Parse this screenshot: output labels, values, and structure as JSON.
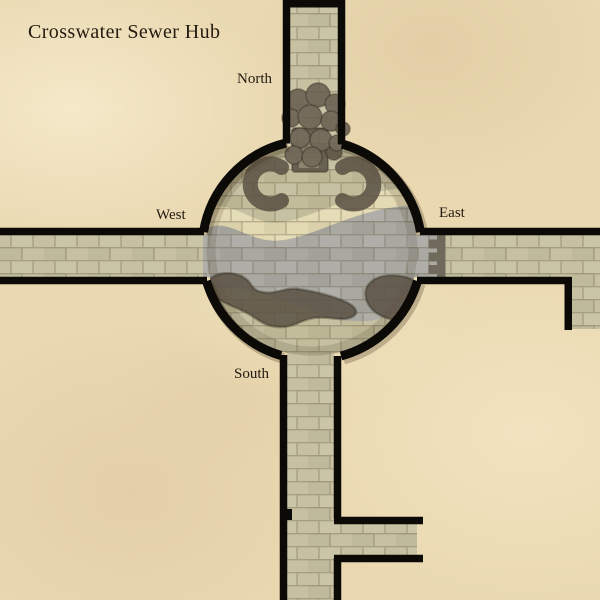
{
  "map": {
    "title": "Crosswater Sewer Hub",
    "direction_labels": {
      "north": "North",
      "west": "West",
      "east": "East",
      "south": "South"
    }
  },
  "colors": {
    "parchment": "#e9d8b0",
    "stone": "#c7c1a1",
    "chamber-stone": "#c2bc9b",
    "channel-gray": "#a9a8a1",
    "pale-band": "#e3d9b3",
    "dark-feature": "#5d5446",
    "boulder": "#6a6052",
    "gate-gray": "#6f6a5c",
    "wall-black": "#0c0a07",
    "label-ink": "#231a10"
  }
}
